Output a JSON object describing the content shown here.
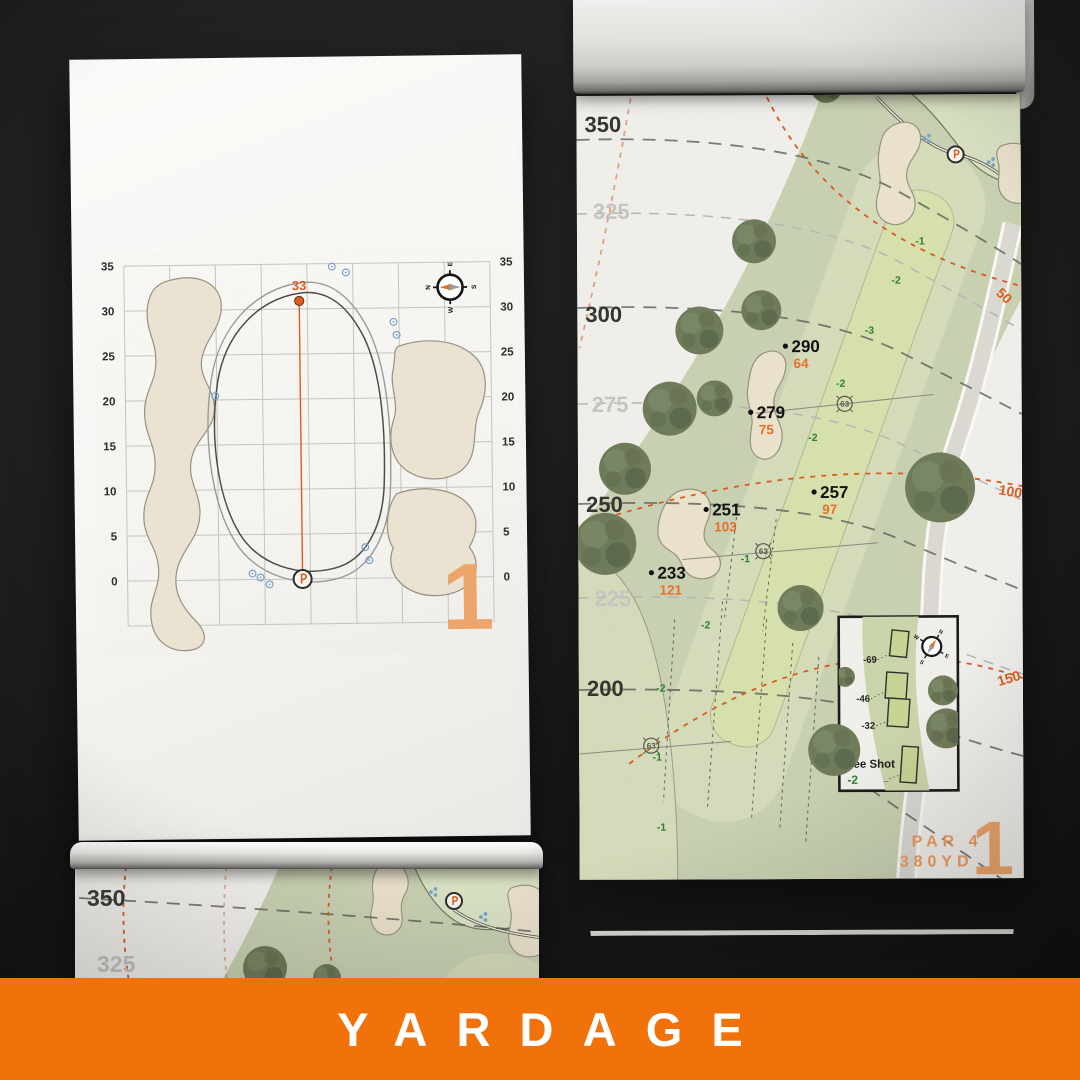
{
  "colors": {
    "banner_bg": "#F1720A",
    "accent_orange": "#DD5B1E",
    "light_orange": "#EDA56B",
    "slope_green": "#2F7D32",
    "rough_green": "#CAD2B3",
    "fairway_green": "#D5DDBB",
    "zone_green": "#D8E2AE",
    "bunker_sand": "#ECE3CD"
  },
  "banner": {
    "title": "YARDAGE"
  },
  "green_page": {
    "pin_distance": "33",
    "hole_number": "1",
    "ticks": [
      "35",
      "30",
      "25",
      "20",
      "15",
      "10",
      "5",
      "0"
    ],
    "compass": {
      "n": "N",
      "e": "E",
      "s": "S",
      "w": "W"
    }
  },
  "hole_page": {
    "hole_number": "1",
    "par_label": "PAR 4",
    "yardage_label": "380YD",
    "distances": [
      {
        "value": "350"
      },
      {
        "value": "325"
      },
      {
        "value": "300"
      },
      {
        "value": "275"
      },
      {
        "value": "250"
      },
      {
        "value": "225"
      },
      {
        "value": "200"
      }
    ],
    "arc_labels": [
      "50",
      "100",
      "150"
    ],
    "markers": [
      {
        "carry": "290",
        "remaining": "64"
      },
      {
        "carry": "279",
        "remaining": "75"
      },
      {
        "carry": "257",
        "remaining": "97"
      },
      {
        "carry": "251",
        "remaining": "103"
      },
      {
        "carry": "233",
        "remaining": "121"
      }
    ],
    "sprinklers": [
      "63",
      "63",
      "63"
    ],
    "slopes": [
      "-1",
      "-2",
      "-3",
      "-2",
      "-2",
      "-1",
      "-2",
      "-2",
      "-1",
      "-1"
    ],
    "tee_inset": {
      "title": "Tee Shot",
      "slope": "-2",
      "tee_distances": [
        "-69",
        "-46",
        "-32"
      ],
      "dash_mark": "--",
      "compass": {
        "n": "N",
        "e": "E",
        "s": "S",
        "w": "W"
      }
    }
  },
  "partial_page": {
    "distances": [
      "350",
      "325"
    ]
  }
}
